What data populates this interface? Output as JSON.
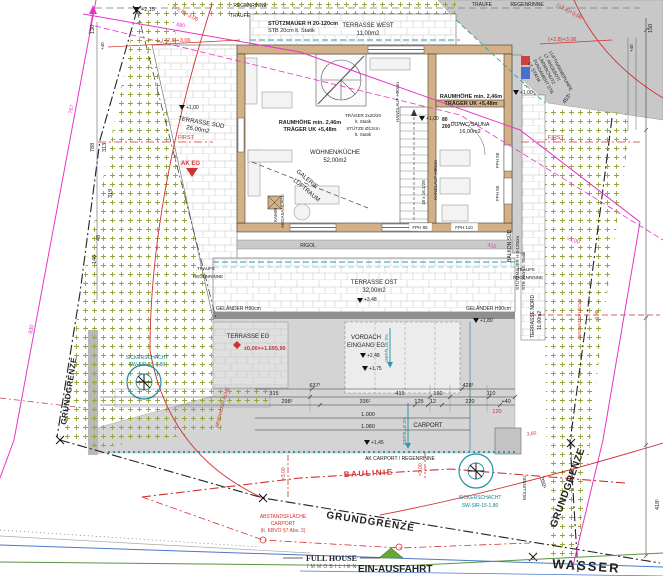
{
  "site": {
    "grundgrenze": "GRUNDGRENZE",
    "baulinie": "BAULINIE",
    "wasser": "WASSER",
    "ein_ausfahrt": "EIN-AUSFAHRT",
    "first": "FIRST",
    "traufe": "TRAUFE",
    "regenrinne": "REGENRINNE",
    "abstand_line1": "ABSTANDSFLÄCHE",
    "abstand_line2": "CARPORT",
    "abstand_line3": "(lt. KBVO §7 Abs. 3)",
    "abstand_vertical": "ABSTANDSFLÄCHE",
    "sickerschacht_line1": "SICKERSCHACHT",
    "sickerschacht_line2": "SW-SIR-15-1,80",
    "muellinsel": "MÜLLINSEL"
  },
  "logo": {
    "name": "FULL HOUSE",
    "sub": "IMMOBILIEN"
  },
  "rooms": {
    "terrasse_west": {
      "name": "TERRASSE WEST",
      "area": "11,00m2"
    },
    "terrasse_sued": {
      "name": "TERRASSE SÜD",
      "area": "26,00m2"
    },
    "terrasse_ost": {
      "name": "TERRASSE OST",
      "area": "32,00m2"
    },
    "terrasse_nord": {
      "name": "TERRASSE NORD",
      "area": "11,00m2"
    },
    "terrasse_eg": {
      "name": "TERRASSE EG",
      "level": "±0,00=+1.695,90"
    },
    "wohnen": {
      "name": "WOHNEN/KÜCHE",
      "area": "52,00m2"
    },
    "sauna": {
      "name": "DU/WC/SAUNA",
      "area": "16,00m2"
    },
    "vordach": {
      "line1": "VORDACH",
      "line2": "EINGANG EG"
    },
    "galerie": {
      "line1": "GALERIE",
      "line2": "LUFTRAUM"
    },
    "kamin": {
      "line1": "KAMIN",
      "line2": "ABGASANLAGE"
    },
    "carport": {
      "name": "CARPORT",
      "ak": "AK CARPORT / REGENRINNE"
    },
    "balkon_sued": "BALKON SÜD",
    "rigol": "RIGOL"
  },
  "notes": {
    "stuetzmauer_top1": "STÜTZMAUER H 20-120cm",
    "stuetzmauer_top2": "STB 20cm lt. Statik",
    "stuetzmauer_right1": "STÜTZMAUER H 0-120cm",
    "stuetzmauer_right2": "STB 20cm lt. Statik",
    "raumhoehe": "RAUMHÖHE min. 2,46m",
    "traeger_uk": "TRÄGER UK +5,48m",
    "traeger1": "TRÄGER 2x20/20",
    "traeger2": "lt. Statik",
    "stuetze1": "STÜTZE Ø13cm",
    "stuetze2": "lt. Statik",
    "handlauf": "HANDLAUF H90cm",
    "stair": "18 x 16,1/28",
    "door_w": "80",
    "door_h": "200",
    "fph85": "FPH 85",
    "fph110": "FPH 110",
    "fph50": "FPH 50",
    "gelaender": "GELÄNDER H90cm",
    "gefaelle": "GEFÄLLE 2%",
    "ak_eg": "AK EG",
    "wp1": "LUFTWÄRMEPUMPE",
    "wp2": "LT. ANGEBOT/",
    "wp3": "LÄRMSCHUTZ",
    "wp4": "FUNDAMENT STB",
    "wp5": "LT. STATIK"
  },
  "levels": {
    "l215": "+2,15",
    "l306": "(+2,8)+3,06",
    "l348": "+3,48",
    "l248": "+2,48",
    "l180": "+1,80",
    "l175": "+1,75",
    "l145": "+1,45",
    "l100": "+1,00"
  },
  "dims": {
    "d130": "130",
    "d40": "+40",
    "d150": "150",
    "d788": "788",
    "d313": "313",
    "d319": "319",
    "d48": "48",
    "d140": "140",
    "d767": "767",
    "d830": "830",
    "d480": "480",
    "d410": "410",
    "d300": "=3,00",
    "d453": "453¹",
    "d418": "418¹",
    "d350": "350¹",
    "d637": "637¹",
    "d428": "428¹",
    "d315": "315",
    "d415": "415",
    "d160": "160",
    "d110": "110",
    "d298": "298¹",
    "d336": "336¹",
    "d125": "125",
    "d12": "12",
    "d220": "220",
    "d1000": "1.000",
    "d1080": "1.080",
    "d120": "120",
    "d360": "3,60"
  }
}
